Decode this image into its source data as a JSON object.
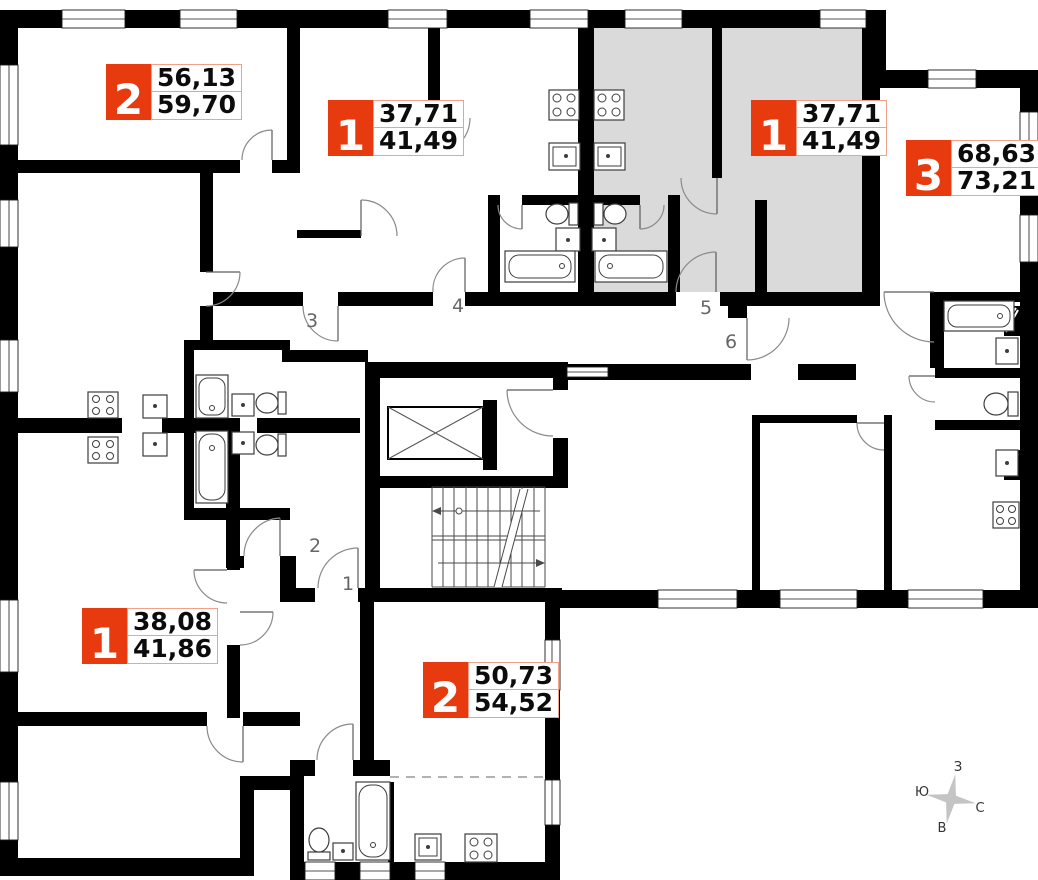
{
  "plan": {
    "title": "floor-plan",
    "apartments": [
      {
        "id": "flat-top-left",
        "rooms": "2",
        "area1": "56,13",
        "area2": "59,70",
        "highlighted": false
      },
      {
        "id": "flat-top-middle",
        "rooms": "1",
        "area1": "37,71",
        "area2": "41,49",
        "highlighted": false
      },
      {
        "id": "flat-top-right",
        "rooms": "1",
        "area1": "37,71",
        "area2": "41,49",
        "highlighted": true
      },
      {
        "id": "flat-right",
        "rooms": "3",
        "area1": "68,63",
        "area2": "73,21",
        "highlighted": false
      },
      {
        "id": "flat-bottom-left",
        "rooms": "1",
        "area1": "38,08",
        "area2": "41,86",
        "highlighted": false
      },
      {
        "id": "flat-bottom-middle",
        "rooms": "2",
        "area1": "50,73",
        "area2": "54,52",
        "highlighted": false
      }
    ],
    "door_numbers": [
      "1",
      "2",
      "3",
      "4",
      "5",
      "6"
    ],
    "compass": {
      "top": "З",
      "left": "Ю",
      "right": "С",
      "bottom": "В"
    },
    "colors": {
      "badge": "#E73B0F",
      "badge_border": "#F2A08C",
      "highlight": "#DADADA",
      "wall": "#000000",
      "door_number": "#666666",
      "compass_star": "#C4C4C4"
    }
  }
}
